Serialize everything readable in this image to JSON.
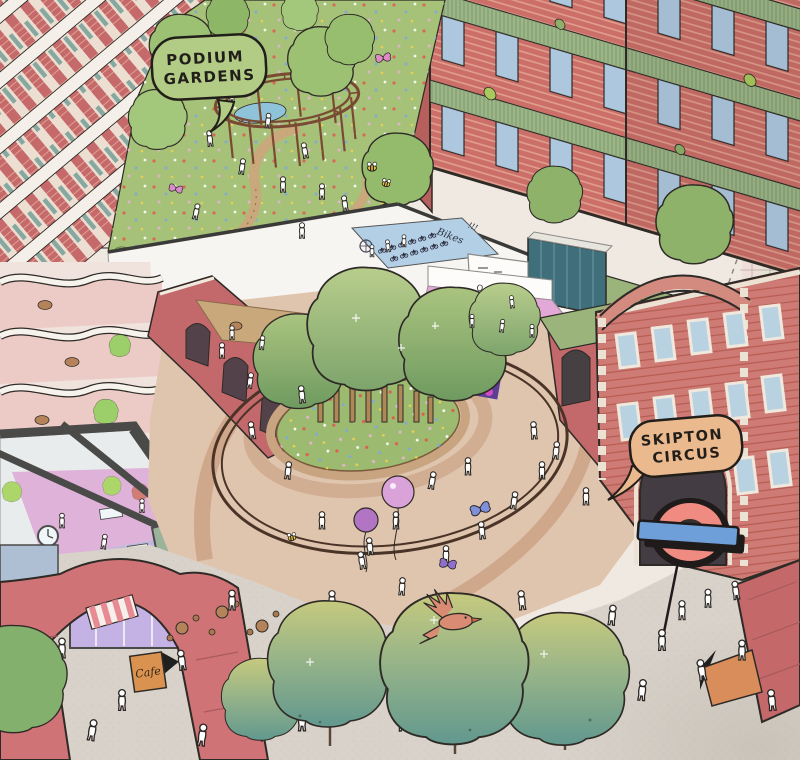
{
  "illustration": {
    "speech_bubbles": {
      "podium": {
        "line1": "PODIUM",
        "line2": "GARDENS"
      },
      "skipton": {
        "line1": "SKIPTON",
        "line2": "CIRCUS"
      }
    },
    "signs": {
      "offices": "OFFICES",
      "bikes": "Bikes",
      "bikes_emphasis": "!!!",
      "cafe": "Cafe"
    },
    "icons": {
      "transit_roundel": "red ring with blue horizontal bar on pole",
      "clock": "wall clock face",
      "bee": "striped bee",
      "butterfly": "butterfly wings",
      "bird_orange": "flying orange bird",
      "birds_black": "flock of black birds"
    },
    "colors": {
      "paper": "#efe9e2",
      "brick": "#c4696b",
      "brick_stripe": "#e2a191",
      "meadow": "#a6c178",
      "tree_teal": "#62988e",
      "bubble_green": "#b2cc86",
      "bubble_peach": "#eab98e",
      "roundel_red": "#ef8b80",
      "roundel_bar": "#6f9fd8",
      "plaza": "#dfc4ae",
      "pavement": "#d8d2ca",
      "bike_floor": "#b3cfe6",
      "terrace_pink": "#e2a8d6",
      "glass_teal": "#3f6f7a",
      "balcony_green": "#9cb687"
    }
  }
}
